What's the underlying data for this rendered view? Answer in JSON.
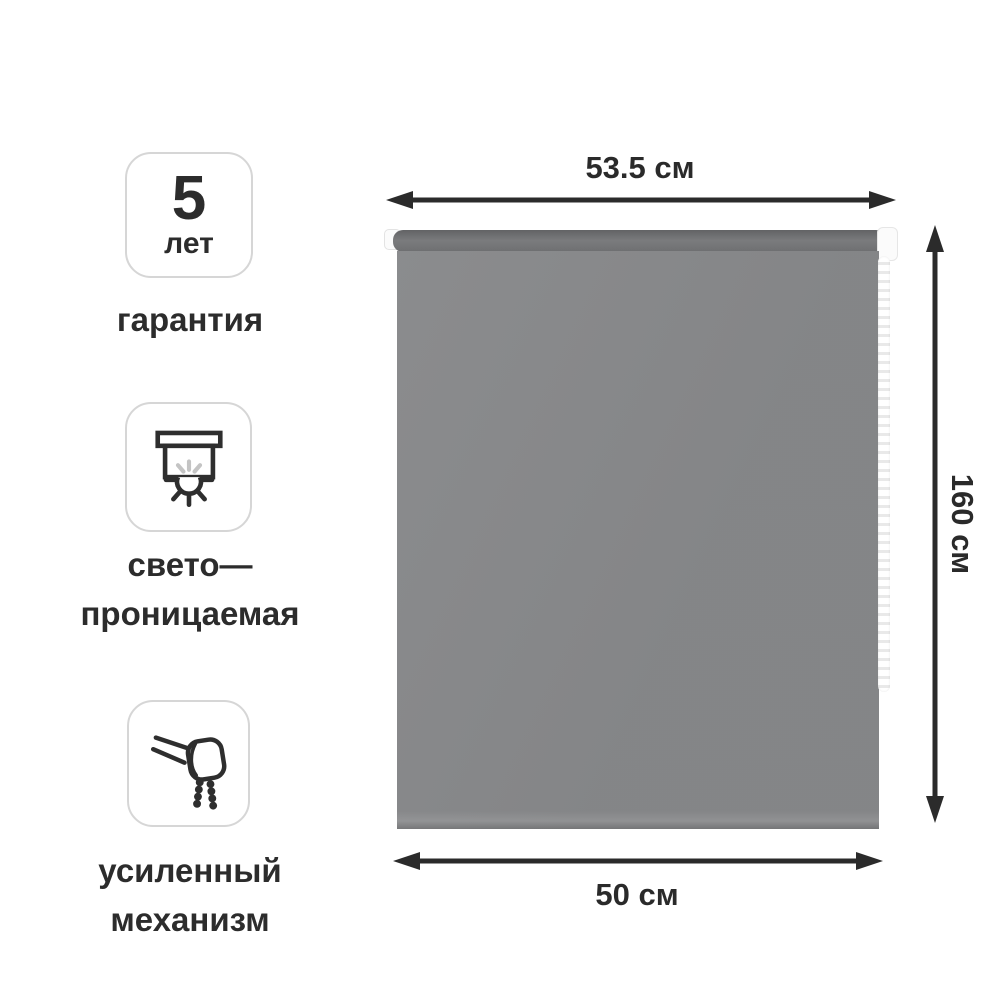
{
  "product": {
    "type": "roller-blind"
  },
  "features": [
    {
      "badge_number": "5",
      "badge_caption": "лет",
      "label_lines": [
        "гарантия"
      ]
    },
    {
      "label_lines": [
        "свето—",
        "проницаемая"
      ]
    },
    {
      "label_lines": [
        "усиленный",
        "механизм"
      ]
    }
  ],
  "dimensions": {
    "full_width": "53.5 см",
    "height": "160 см",
    "fabric_width": "50 см"
  },
  "colors": {
    "fabric": "#87888a",
    "tube-dark": "#626365",
    "tube-light": "#7a7b7d",
    "arrow": "#2b2b2b",
    "text": "#2c2c2c",
    "badge-border": "#d6d6d6",
    "icon-stroke": "#2e2e2e",
    "icon-ray": "#c4c4c4",
    "chain": "#f7f7f7"
  }
}
